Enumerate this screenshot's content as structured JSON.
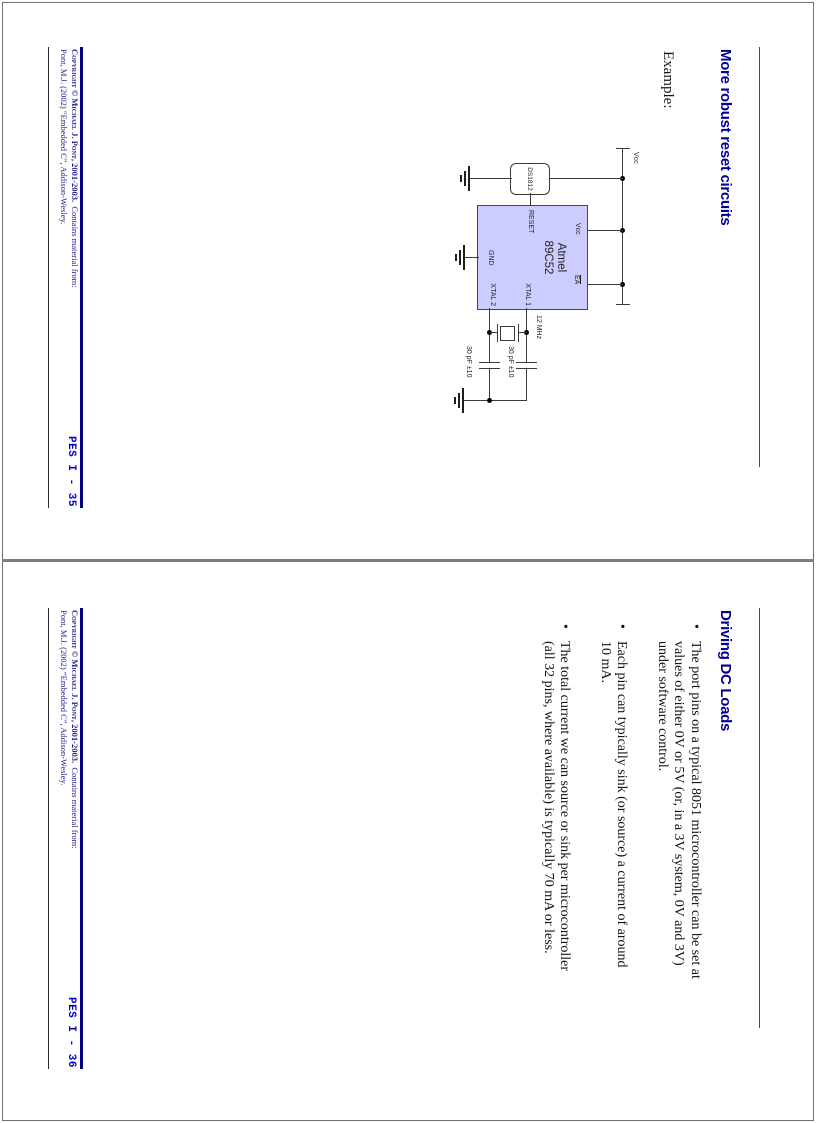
{
  "colors": {
    "title_navy": "#000099",
    "footer_rule_navy": "#000080",
    "page_number_blue": "#0000cc",
    "mcu_fill": "#ccccff"
  },
  "footer_common": {
    "copyright_smallcaps": "Copyright © Michael J. Pont, 2001-2003.",
    "contains_note": "Contains material from:",
    "source_line": "Pont, M.J. (2002) “Embedded C”, Addison-Wesley."
  },
  "slides": [
    {
      "title": "More robust reset circuits",
      "page_number": "PES I - 35",
      "example_label": "Example:",
      "circuit": {
        "vcc_label": "Vcc",
        "reset_chip": "DS1812",
        "mcu_name_line1": "Atmel",
        "mcu_name_line2": "89C52",
        "pin_vcc": "Vcc",
        "pin_ea": "EA",
        "pin_reset": "RESET",
        "pin_gnd": "GND",
        "pin_xtal1": "XTAL 1",
        "pin_xtal2": "XTAL 2",
        "crystal_value": "12 MHz",
        "cap1_value": "30 pF ±10",
        "cap2_value": "30 pF ±10"
      }
    },
    {
      "title": "Driving DC Loads",
      "page_number": "PES I - 36",
      "bullets": [
        {
          "lines": [
            "The port pins on a typical 8051 microcontroller can be set at",
            "values of either 0V or 5V (or, in a 3V system, 0V and 3V)",
            "under software control."
          ]
        },
        {
          "lines": [
            "Each pin can typically sink (or source) a current of around",
            "10 mA."
          ]
        },
        {
          "lines": [
            "The total current we can source or sink per microcontroller",
            "(all 32 pins, where available) is typically 70 mA or less."
          ]
        }
      ]
    }
  ]
}
